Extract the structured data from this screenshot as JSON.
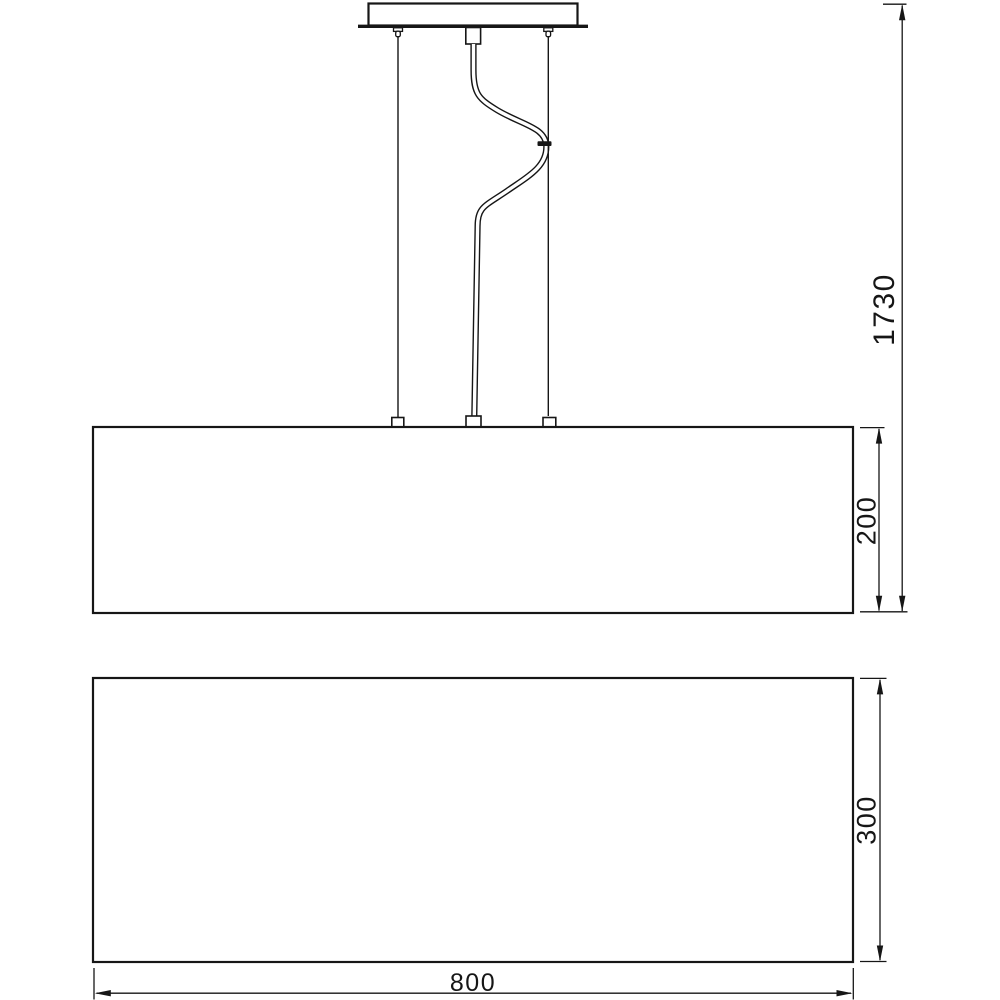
{
  "dimensions": {
    "overall_drop": "1730",
    "shade_height": "200",
    "lower_body_height": "300",
    "width": "800"
  },
  "colors": {
    "line": "#161616",
    "background": "#ffffff"
  }
}
